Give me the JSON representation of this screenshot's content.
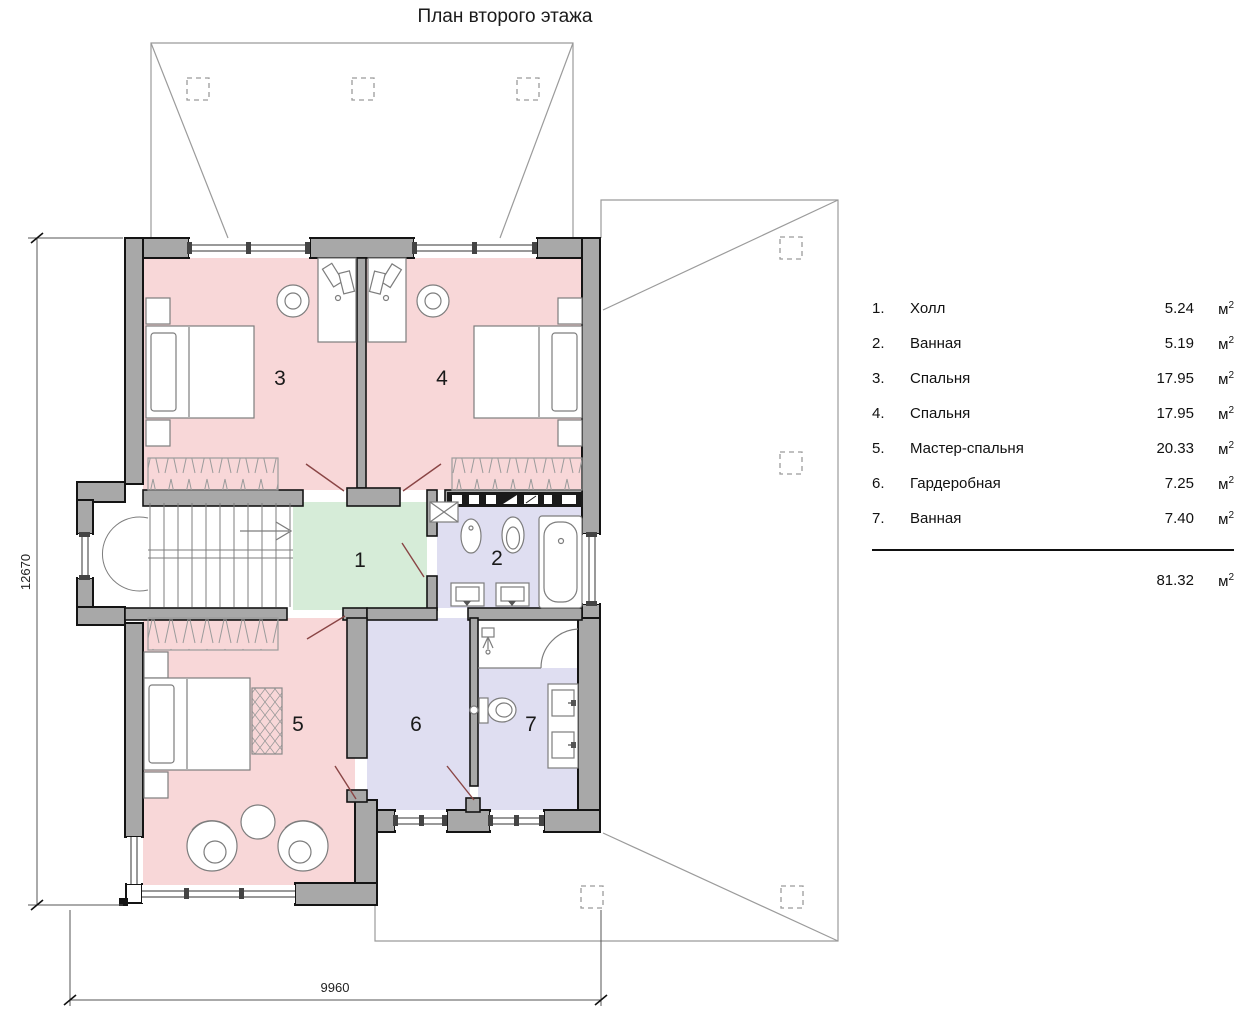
{
  "title": "План второго этажа",
  "legend": {
    "rows": [
      {
        "num": "1.",
        "name": "Холл",
        "area": "5.24",
        "unit": "м",
        "unit_sup": "2"
      },
      {
        "num": "2.",
        "name": "Ванная",
        "area": "5.19",
        "unit": "м",
        "unit_sup": "2"
      },
      {
        "num": "3.",
        "name": "Спальня",
        "area": "17.95",
        "unit": "м",
        "unit_sup": "2"
      },
      {
        "num": "4.",
        "name": "Спальня",
        "area": "17.95",
        "unit": "м",
        "unit_sup": "2"
      },
      {
        "num": "5.",
        "name": "Мастер-спальня",
        "area": "20.33",
        "unit": "м",
        "unit_sup": "2"
      },
      {
        "num": "6.",
        "name": "Гардеробная",
        "area": "7.25",
        "unit": "м",
        "unit_sup": "2"
      },
      {
        "num": "7.",
        "name": "Ванная",
        "area": "7.40",
        "unit": "м",
        "unit_sup": "2"
      }
    ],
    "total_area": "81.32",
    "total_unit": "м",
    "total_unit_sup": "2"
  },
  "plan": {
    "room_numbers": {
      "r1": "1",
      "r2": "2",
      "r3": "3",
      "r4": "4",
      "r5": "5",
      "r6": "6",
      "r7": "7"
    },
    "dim_left": "12670",
    "dim_bottom": "9960"
  },
  "colors": {
    "bedroom": "#f8d7d8",
    "hall": "#d6ecd8",
    "wet": "#dfdef1",
    "wall": "#a8a8a8"
  }
}
